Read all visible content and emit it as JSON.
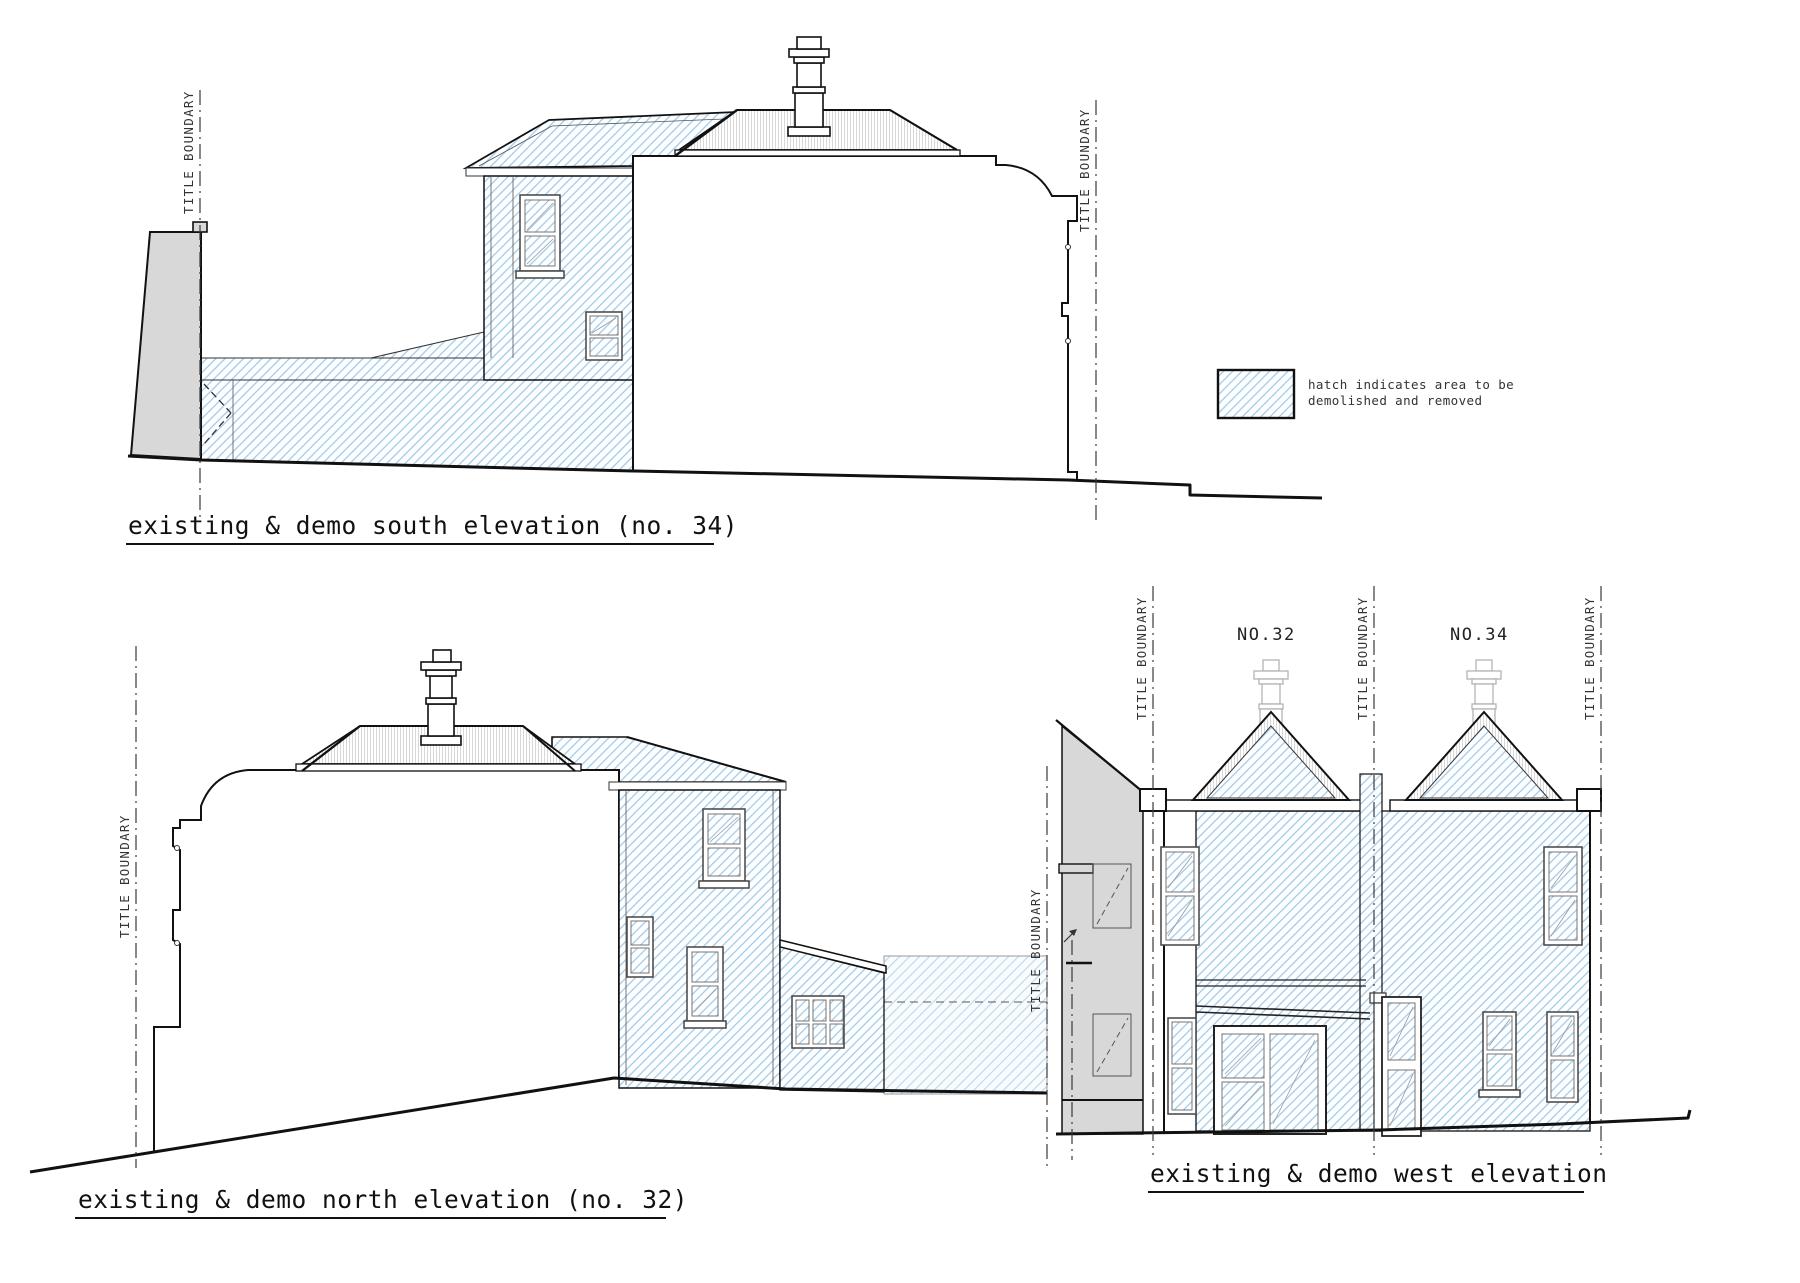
{
  "sheet": {
    "kind": "architectural elevation drawing",
    "background": "#ffffff"
  },
  "boundary_label": "TITLE BOUNDARY",
  "legend": {
    "line1": "hatch indicates area to be",
    "line2": "demolished and removed"
  },
  "drawings": {
    "south": {
      "title": "existing & demo south elevation (no. 34)"
    },
    "north": {
      "title": "existing & demo north elevation (no. 32)"
    },
    "west": {
      "title": "existing & demo west elevation",
      "house_left_label": "NO.32",
      "house_right_label": "NO.34"
    }
  },
  "colors": {
    "demo_hatch_blue": "#96c3e3",
    "demo_hatch_blue_light": "#b9d6ea",
    "roof_texture_gray": "#cfcfcf",
    "section_gray": "#d8d8d8",
    "outline_black": "#1a1a1a",
    "boundary_line": "#3a3a3a",
    "ghost_gray": "#b3b3b3"
  }
}
